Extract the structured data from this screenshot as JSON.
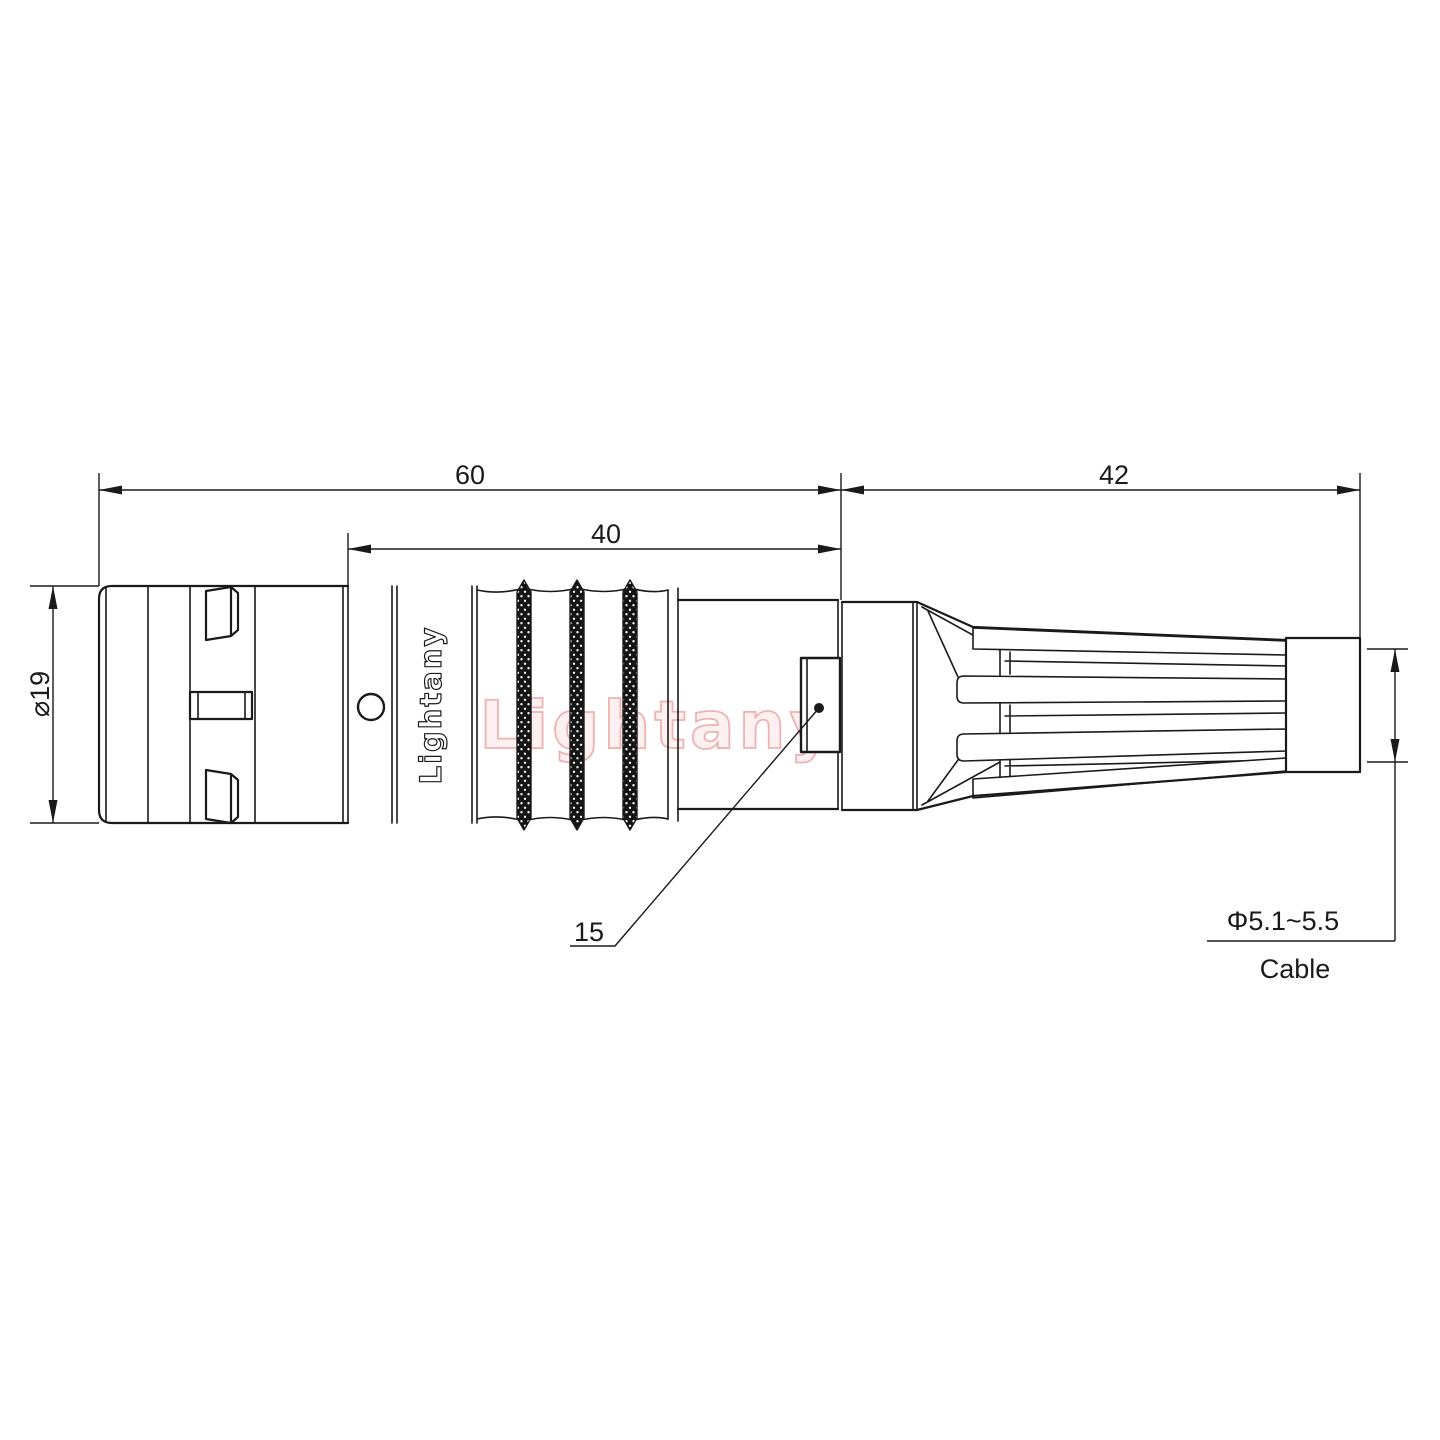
{
  "drawing": {
    "watermark": "Lightany",
    "brand_on_body": "Lightany",
    "dim_total_length": "60",
    "dim_rear_length": "42",
    "dim_grip_length": "40",
    "dim_front_diameter": "⌀19",
    "dim_window_ref": "15",
    "dim_cable_diameter": "Φ5.1~5.5",
    "dim_cable_label": "Cable",
    "colors": {
      "line": "#1a1a1a",
      "watermark_fill": "#fdf0f0",
      "watermark_stroke": "#eeb2b2",
      "background": "#ffffff"
    }
  }
}
